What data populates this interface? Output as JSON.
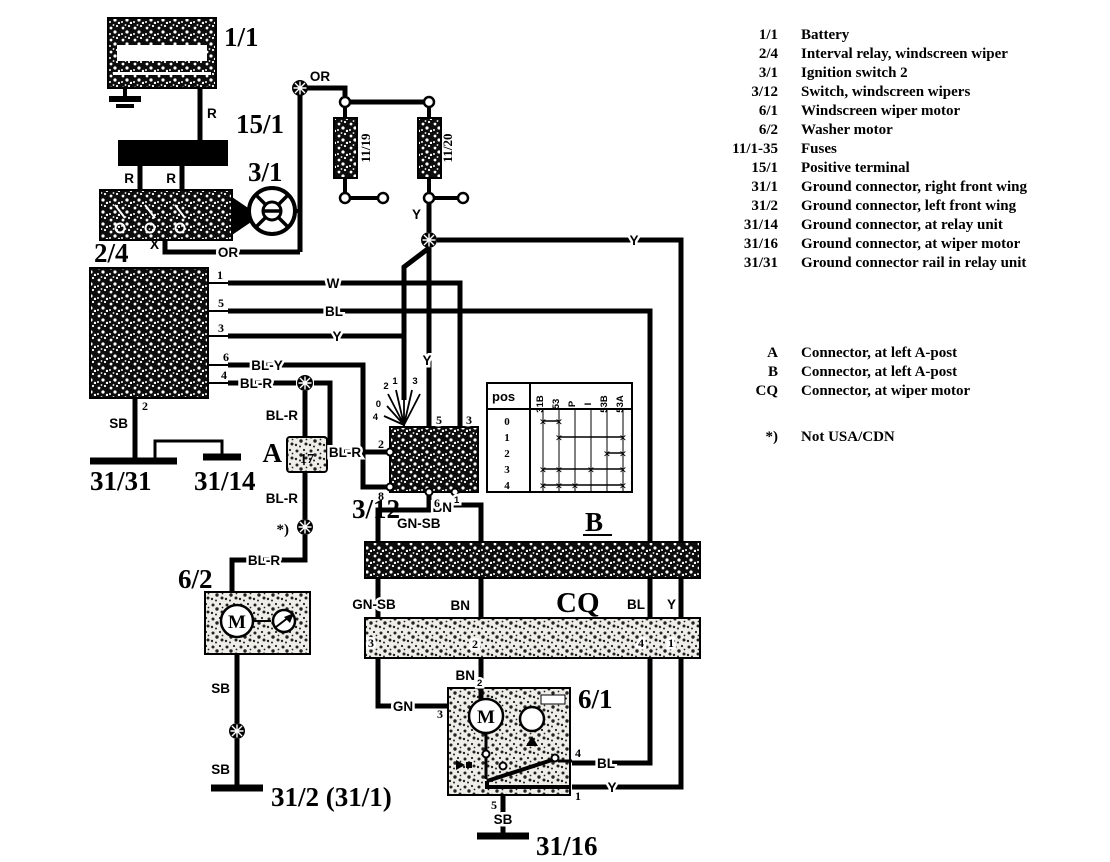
{
  "labels": {
    "battery": "1/1",
    "pos_term": "15/1",
    "ignition": "3/1",
    "relay": "2/4",
    "switch3_12": "3/12",
    "washer": "6/2",
    "motor": "6/1",
    "conn_a": "A",
    "conn_a_pin": "17",
    "conn_b": "B",
    "conn_cq": "CQ",
    "g31_31": "31/31",
    "g31_14": "31/14",
    "g31_2": "31/2 (31/1)",
    "g31_16": "31/16",
    "fuse_l": "11/19",
    "fuse_r": "11/20",
    "note": "*)",
    "motor_m": "M",
    "washer_m": "M"
  },
  "wires": {
    "r_batt": "R",
    "r_l": "R",
    "r_r": "R",
    "x": "X",
    "or_b": "OR",
    "or_t": "OR",
    "y_fuse": "Y",
    "y_main": "Y",
    "y_relay": "Y",
    "y_switch": "Y",
    "w": "W",
    "bl": "BL",
    "bly": "BL-Y",
    "blr1": "BL-R",
    "blr2": "BL-R",
    "blr3": "BL-R",
    "blr4": "BL-R",
    "blr5": "BL-R",
    "sb1": "SB",
    "sb2": "SB",
    "sb3": "SB",
    "sb4": "SB",
    "gnsb1": "GN-SB",
    "gnsb2": "GN-SB",
    "bn_top": "BN",
    "bn_top_sup": "1",
    "bn_mid": "BN",
    "bn_low": "BN",
    "bn_low_sub": "2",
    "gn": "GN",
    "bl_mid": "BL",
    "bl_mot": "BL",
    "y_mid": "Y",
    "y_mot": "Y"
  },
  "pins": {
    "relay_1": "1",
    "relay_5": "5",
    "relay_3": "3",
    "relay_6": "6",
    "relay_4": "4",
    "relay_2": "2",
    "sw_5": "5",
    "sw_3": "3",
    "sw_2": "2",
    "sw_8": "8",
    "sw_6": "6",
    "fan_a": "2",
    "fan_b": "1",
    "fan_c": "0",
    "fan_d": "3",
    "fan_e": "0",
    "fan_f": "4",
    "cq_3": "3",
    "cq_2": "2",
    "cq_4": "4",
    "cq_1": "1",
    "mot_3": "3",
    "mot_4": "4",
    "mot_1": "1",
    "mot_5": "5"
  },
  "pos_table": {
    "header": "pos",
    "mark": "×",
    "terminals": [
      "31B",
      "53",
      "P",
      "I",
      "53B",
      "53A"
    ],
    "rows": [
      {
        "pos": "0",
        "marks": [
          1,
          2
        ]
      },
      {
        "pos": "1",
        "marks": [
          2,
          6
        ]
      },
      {
        "pos": "2",
        "marks": [
          5,
          6
        ]
      },
      {
        "pos": "3",
        "marks": [
          1,
          2,
          4,
          6
        ]
      },
      {
        "pos": "4",
        "marks": [
          1,
          2,
          3,
          6
        ]
      }
    ]
  },
  "legend": {
    "components": [
      {
        "id": "1/1",
        "desc": "Battery"
      },
      {
        "id": "2/4",
        "desc": "Interval relay, windscreen wiper"
      },
      {
        "id": "3/1",
        "desc": "Ignition switch 2"
      },
      {
        "id": "3/12",
        "desc": "Switch, windscreen wipers"
      },
      {
        "id": "6/1",
        "desc": "Windscreen wiper motor"
      },
      {
        "id": "6/2",
        "desc": "Washer motor"
      },
      {
        "id": "11/1-35",
        "desc": "Fuses"
      },
      {
        "id": "15/1",
        "desc": "Positive terminal"
      },
      {
        "id": "31/1",
        "desc": "Ground connector, right front wing"
      },
      {
        "id": "31/2",
        "desc": "Ground connector, left front wing"
      },
      {
        "id": "31/14",
        "desc": "Ground connector, at relay unit"
      },
      {
        "id": "31/16",
        "desc": "Ground connector, at wiper motor"
      },
      {
        "id": "31/31",
        "desc": "Ground connector rail in relay unit"
      }
    ],
    "connectors": [
      {
        "id": "A",
        "desc": "Connector, at left A-post"
      },
      {
        "id": "B",
        "desc": "Connector, at left A-post"
      },
      {
        "id": "CQ",
        "desc": "Connector, at wiper motor"
      }
    ],
    "note_symbol": "*)",
    "note_text": "Not USA/CDN"
  }
}
